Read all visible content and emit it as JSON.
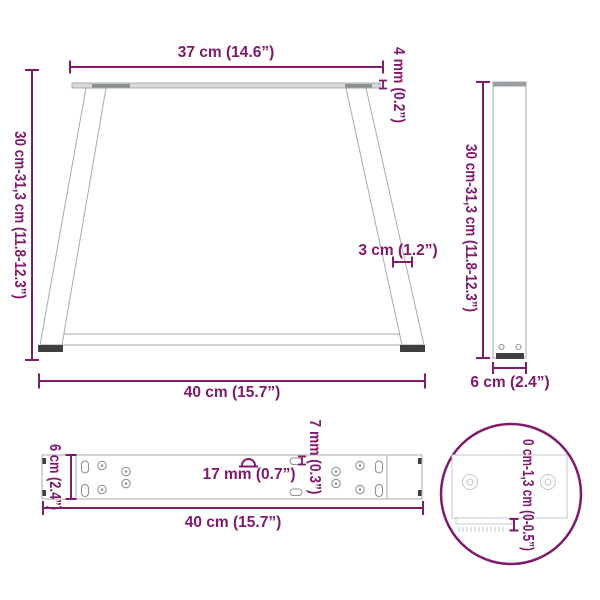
{
  "colors": {
    "accent": "#801a6b",
    "drawing_gray": "#a7aaac",
    "foot_dark": "#3f3f41"
  },
  "front": {
    "top_width": "37 cm (14.6”)",
    "plate_thickness": "4 mm (0.2”)",
    "height": "30 cm-31,3 cm (11.8-12.3”)",
    "leg_width": "3 cm (1.2”)",
    "bottom_width": "40 cm (15.7”)"
  },
  "side": {
    "height": "30 cm-31,3 cm (11.8-12.3”)",
    "depth": "6 cm (2.4”)"
  },
  "plate": {
    "width": "6 cm (2.4”)",
    "hole_size": "17 mm (0.7”)",
    "slot_width": "7 mm (0.3”)",
    "length": "40 cm (15.7”)"
  },
  "detail": {
    "foot_adjustment": "0 cm-1,3 cm (0-0.5”)"
  }
}
